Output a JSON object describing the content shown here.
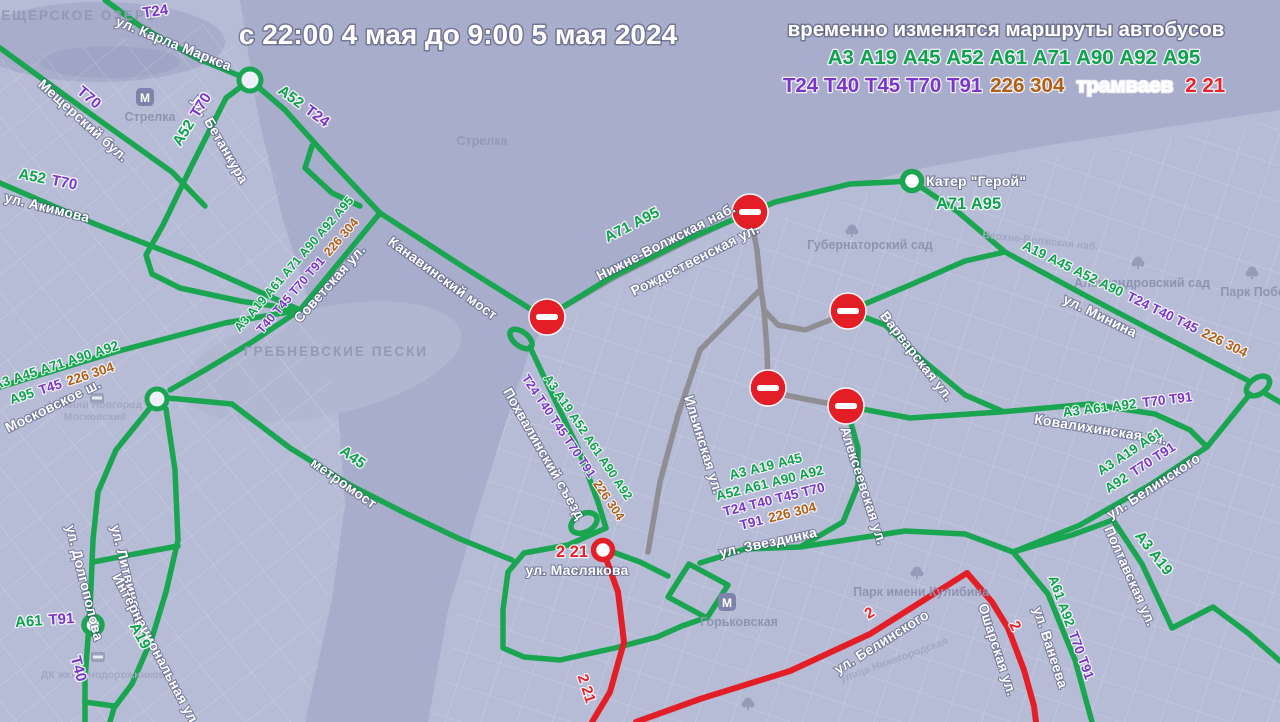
{
  "header": {
    "title": "с 22:00 4 мая до 9:00 5 мая 2024",
    "notice": "временно изменятся маршруты автобусов",
    "buses_green": "А3 А19 А45 А52 А61 А71 А90 А92 А95",
    "buses_purple": "Т24 Т40 Т45 Т70 Т91",
    "buses_suburban": "226 304",
    "trams_label": "трамваев",
    "trams": "2 21"
  },
  "colors": {
    "bus_green": "#0ea24c",
    "trolleybus_purple": "#7a36c8",
    "suburban_brown": "#b05f16",
    "tram_red": "#e41e26",
    "closed_gray": "#8e8e93",
    "water": "#a7adca",
    "land": "#b6bbd6"
  },
  "streets": {
    "karla_marksa": "ул. Карла Маркса",
    "meshchersky": "Мещерский бул.",
    "betankura": "ул. Бетанкура",
    "akimova": "ул. Акимова",
    "sovetskaya": "Советская ул.",
    "moskovskoe": "Московское ш.",
    "kanavinsky": "Канавинский мост",
    "metromost": "метромост",
    "nizhnevolzhskaya": "Нижне-Волжская наб.",
    "rozhdestvenskaya": "Рождественская ул.",
    "pokhvalinsky": "Похвалинский съезд",
    "ilyinskaya": "Ильинская ул.",
    "zvezdinka": "ул. Звездинка",
    "alekseevskaya": "Алексеевская ул.",
    "varvarskaya": "Варварская ул.",
    "minina": "ул. Минина",
    "kovalikhinskaya": "Ковалихинская ул.",
    "belinskogo_right": "ул. Белинского",
    "belinskogo_bottom": "ул. Белинского",
    "osharskaya": "Ошарская ул.",
    "vaneeva": "ул. Ванеева",
    "poltavskaya": "Полтавская ул.",
    "maslyakova": "ул. Маслякова",
    "dolgopolova": "ул. Долгополова",
    "litvinova": "ул. Литвинова",
    "internatsionalnaya": "Интернациональная ул."
  },
  "areas": {
    "meshcherskoe_ozero": "МЕЩЕРСКОЕ ОЗЕРО",
    "grebnevskie_peski": "ГРЕБНЕВСКИЕ ПЕСКИ",
    "strelka_metro": "Стрелка",
    "strelka_area": "Стрелка",
    "gubernatorsky_sad": "Губернаторский сад",
    "alexandrovsky_sad": "Александровский сад",
    "park_pobedy": "Парк Победы",
    "park_kulibina": "Парк имени Кулибина",
    "gorkovskaya_metro": "Горьковская",
    "nn_moskovsky_1": "Нижний Новгород",
    "nn_moskovsky_2": "Московский",
    "dk_zheleznodorozhnikov": "ДК железнодорожников",
    "verkhnevolzhskaya": "Верхне-Волжская наб.",
    "nizhegorodskaya": "улица Нижегородская",
    "metro_letter": "М"
  },
  "routes": {
    "t24_top": "Т24",
    "t70_left": "Т70",
    "a52t70_betankura": {
      "green": "А52",
      "purple": "Т70"
    },
    "a52t24": {
      "green": "А52",
      "purple": "Т24"
    },
    "a52t70_akimova": {
      "green": "А52",
      "purple": "Т70"
    },
    "sovetskaya_l1": "А3 А19 А61 А71 А90 А92 А95",
    "sovetskaya_l2": {
      "purple": "Т40 Т45 Т70 Т91",
      "brown": "226 304"
    },
    "moskovskoe_l1": "А3 А45 А71 А90 А92",
    "moskovskoe_l2": {
      "green": "А95",
      "purple": "Т45",
      "brown": "226 304"
    },
    "a45": "А45",
    "a71a95_emb": "А71 А95",
    "kater_label": "Катер \"Герой\"",
    "kater_routes": "А71 А95",
    "minina": {
      "green": "А19 А45 А52 А90",
      "purple": "Т24 Т40 Т45",
      "brown": "226 304"
    },
    "kovalikhinskaya": {
      "green": "А3 А61 А92",
      "purple": "Т70 Т91"
    },
    "belinskogo_l1": "А3 А19 А61",
    "belinskogo_l2": {
      "green": "А92",
      "purple": "Т70 Т91"
    },
    "a3a19": "А3 А19",
    "vaneeva": {
      "green": "А61 А92",
      "purple": "Т70 Т91"
    },
    "center_l1": "А3 А19 А45",
    "center_l2": "А52 А61 А90 А92",
    "center_l3": "Т24 Т40 Т45 Т70",
    "center_l4": {
      "purple": "Т91",
      "brown": "226 304"
    },
    "pokhv_l1": "А3 А19 А52 А61 А90 А92",
    "pokhv_l2": {
      "purple": "Т24 Т40 Т45 Т70 Т91",
      "brown": "226 304"
    },
    "tram_maslyakova": "2 21",
    "tram_bottom": "2 21",
    "tram_belinskogo": "2",
    "tram_osharskaya": "2",
    "a61t91": {
      "green": "А61",
      "purple": "Т91"
    },
    "a19_left": "А19",
    "t40_left": "Т40"
  }
}
